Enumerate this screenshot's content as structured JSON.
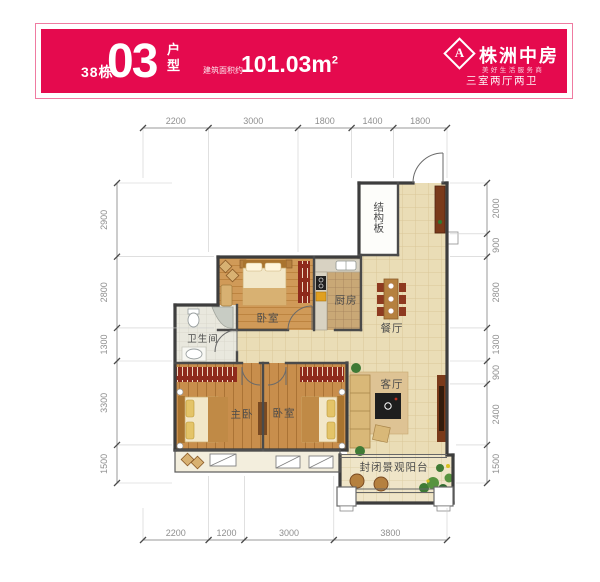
{
  "header": {
    "building": "38栋",
    "unit_number": "03",
    "unit_suffix_top": "户",
    "unit_suffix_bottom": "型",
    "area_prefix": "建筑面积约",
    "area_value": "101.03m",
    "area_sup": "2",
    "accent_color": "#e50a4e",
    "brand": {
      "logo_letter": "A",
      "name": "株洲中房",
      "tagline": "美好生活服务商",
      "layout_desc": "三室两厅两卫"
    }
  },
  "plan": {
    "rooms": {
      "structure": "结构板",
      "bedroom_top": "卧室",
      "kitchen": "厨房",
      "dining": "餐厅",
      "bathroom": "卫生间",
      "master": "主卧",
      "bedroom2": "卧室",
      "living": "客厅",
      "balcony": "封闭景观阳台"
    },
    "dimensions": {
      "top": [
        "2200",
        "3000",
        "1800",
        "1400",
        "1800"
      ],
      "bottom": [
        "2200",
        "1200",
        "3000",
        "3800"
      ],
      "left": [
        "2900",
        "2800",
        "1300",
        "3300",
        "1500"
      ],
      "right": [
        "2000",
        "900",
        "2800",
        "1300",
        "900",
        "2400",
        "1500"
      ]
    },
    "colors": {
      "wall": "#3d3d3d",
      "tile_floor": "#eaddb6",
      "wood_floor": "#c88e4c",
      "wardrobe_red": "#8e2a1c"
    }
  }
}
